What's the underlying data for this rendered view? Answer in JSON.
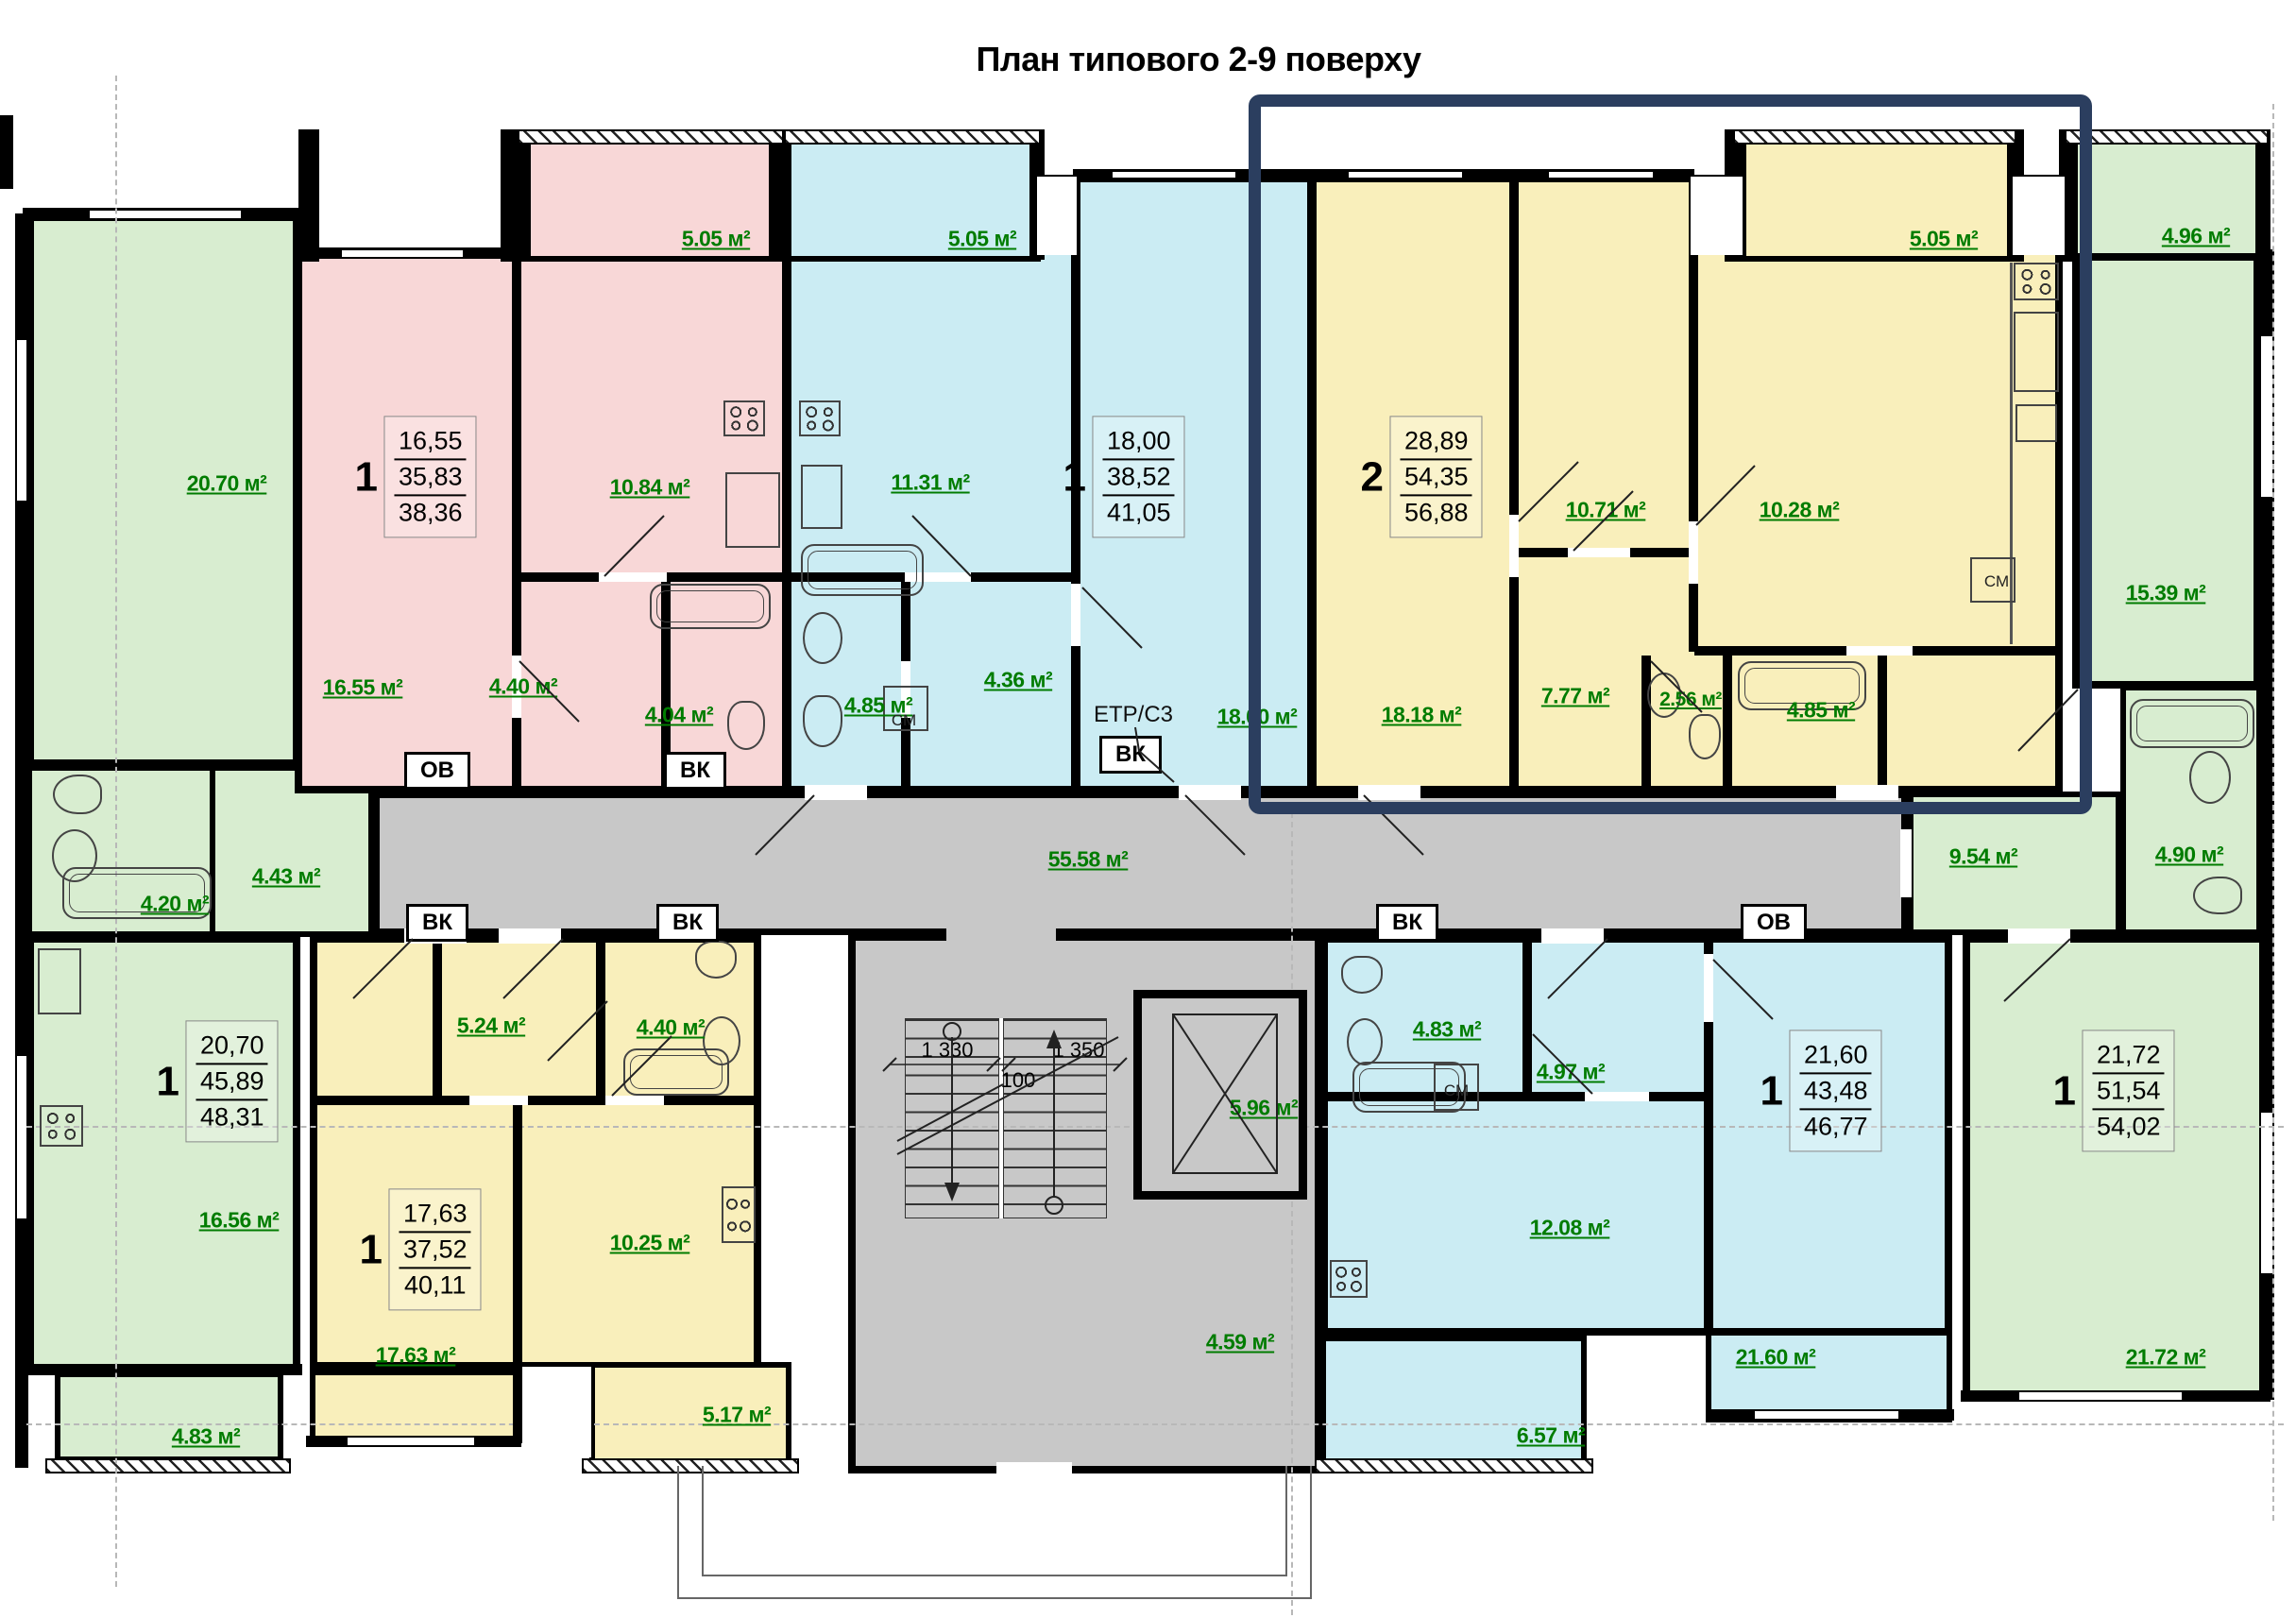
{
  "title": "План типового 2-9 поверху",
  "corridor": {
    "area": "55.58 м²"
  },
  "stairwell": {
    "dim_left": "1 330",
    "dim_mid": "100",
    "dim_right": "1 350",
    "elevator_area": "5.96 м²",
    "lobby_area": "4.59 м²"
  },
  "labels": {
    "ov": "ОВ",
    "vk": "ВК",
    "cm": "СМ",
    "etr": "ЕТР/С3"
  },
  "apartments": [
    {
      "key": "pink-1room",
      "type": "1",
      "spec": [
        "16,55",
        "35,83",
        "38,36"
      ],
      "rooms": {
        "balcony": "5.05 м²",
        "kitchen": "10.84 м²",
        "living": "16.55 м²",
        "hall": "4.40 м²",
        "bath": "4.04 м²"
      }
    },
    {
      "key": "cyan-1room",
      "type": "1",
      "spec": [
        "18,00",
        "38,52",
        "41,05"
      ],
      "rooms": {
        "balcony": "5.05 м²",
        "kitchen": "11.31 м²",
        "hall": "4.36 м²",
        "bath": "4.85 м²",
        "living": "18.00 м²"
      }
    },
    {
      "key": "yellow-2room-highlighted",
      "type": "2",
      "spec": [
        "28,89",
        "54,35",
        "56,88"
      ],
      "rooms": {
        "balcony": "5.05 м²",
        "bedroom": "10.71 м²",
        "kitchen_dining": "10.28 м²",
        "living": "18.18 м²",
        "kitchen": "7.77 м²",
        "wc": "2.56 м²",
        "bath": "4.85 м²"
      }
    },
    {
      "key": "green-right-1room",
      "type": "1",
      "spec": [
        "21,72",
        "51,54",
        "54,02"
      ],
      "rooms": {
        "balcony": "4.96 м²",
        "bedroom": "15.39 м²",
        "hall": "9.54 м²",
        "bath": "4.90 м²",
        "living": "21.72 м²"
      }
    },
    {
      "key": "green-left-1room",
      "type": "1",
      "spec": [
        "20,70",
        "45,89",
        "48,31"
      ],
      "rooms": {
        "bedroom": "20.70 м²",
        "bath": "4.20 м²",
        "hall": "4.43 м²",
        "living": "16.56 м²",
        "balcony": "4.83 м²"
      }
    },
    {
      "key": "yellow-bottom-1room",
      "type": "1",
      "spec": [
        "17,63",
        "37,52",
        "40,11"
      ],
      "rooms": {
        "hall": "5.24 м²",
        "bath": "4.40 м²",
        "kitchen": "10.25 м²",
        "living": "17.63 м²",
        "balcony": "5.17 м²"
      }
    },
    {
      "key": "cyan-bottom-1room",
      "type": "1",
      "spec": [
        "21,60",
        "43,48",
        "46,77"
      ],
      "rooms": {
        "bath": "4.83 м²",
        "hall": "4.97 м²",
        "kitchen": "12.08 м²",
        "living": "21.60 м²",
        "balcony": "6.57 м²"
      }
    }
  ],
  "colors": {
    "pink": "#f8d7d7",
    "cyan": "#cbecf3",
    "yellow": "#f9efbb",
    "green": "#d8edd0",
    "gray": "#c8c8c8",
    "highlight": "#2b3e5f",
    "label_green": "#007c00",
    "wall": "#000000"
  }
}
